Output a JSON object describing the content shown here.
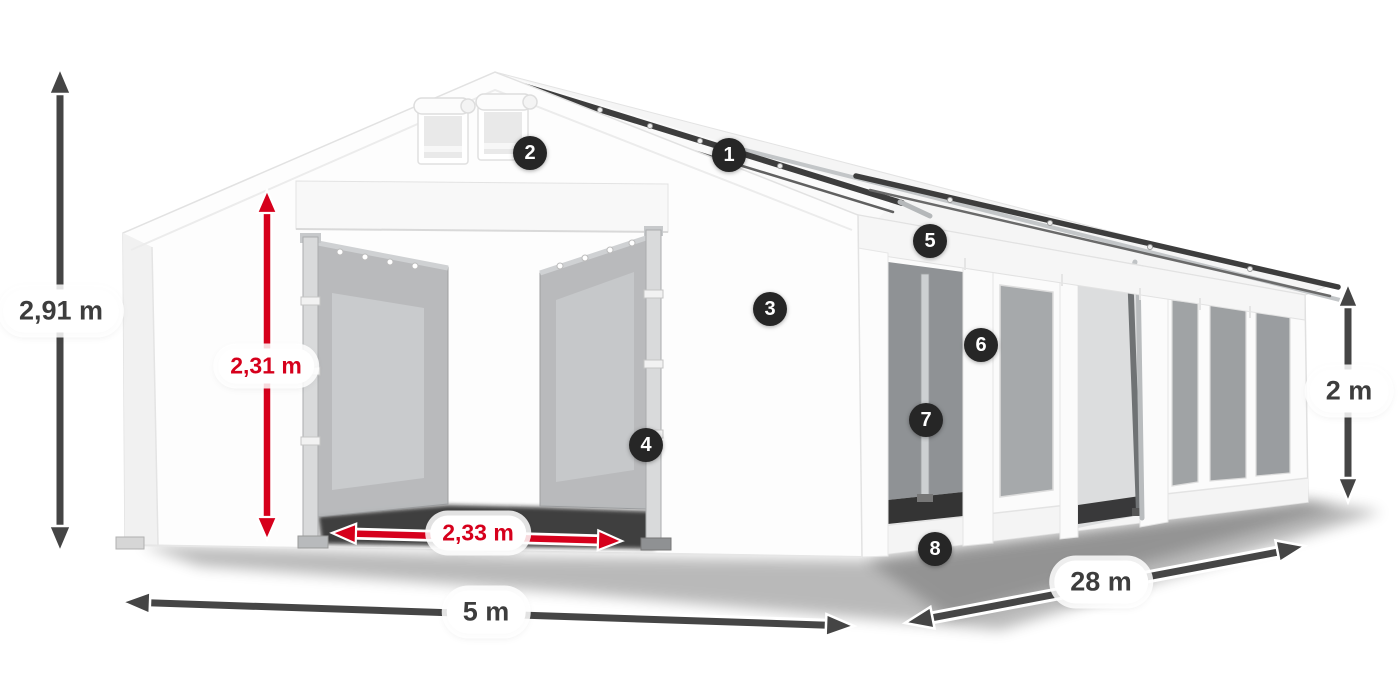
{
  "diagram": {
    "subject": "tent-dimensions",
    "dimensions": {
      "total_height": "2,91 m",
      "entrance_height": "2,31 m",
      "entrance_width": "2,33 m",
      "width": "5 m",
      "length": "28 m",
      "side_height": "2 m"
    },
    "callouts": {
      "c1": "1",
      "c2": "2",
      "c3": "3",
      "c4": "4",
      "c5": "5",
      "c6": "6",
      "c7": "7",
      "c8": "8"
    },
    "colors": {
      "dimension_arrow": "#454545",
      "highlight_arrow": "#d6001c",
      "badge_background": "#262626",
      "badge_text": "#ffffff",
      "label_background": "#ffffff",
      "label_text_dark": "#3d3d3d",
      "label_text_red": "#d6001c"
    }
  }
}
